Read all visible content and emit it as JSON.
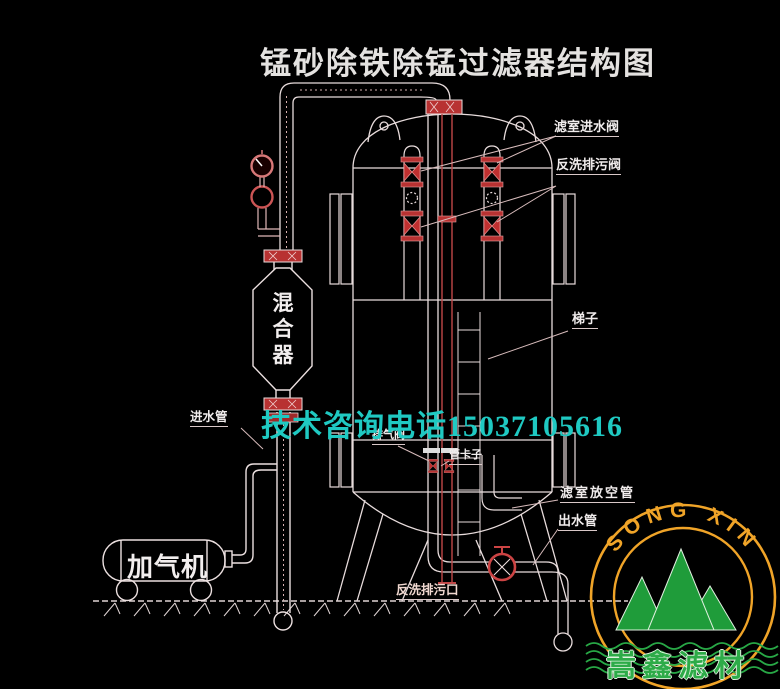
{
  "title": "锰砂除铁除锰过滤器结构图",
  "contact": {
    "phone_note": "技术咨询电话15037105616"
  },
  "labels": {
    "filter_inlet_valve": "滤室进水阀",
    "backwash_drain_valve": "反洗排污阀",
    "ladder": "梯子",
    "exhaust_valve": "排气阀",
    "pipe_clamp": "管卡子",
    "inlet_pipe": "进水管",
    "filter_vent_pipe": "滤室放空管",
    "outlet_pipe": "出水管",
    "backwash_drain_outlet": "反洗排污口"
  },
  "equipment": {
    "mixer": "混合器",
    "aerator": "加气机"
  },
  "logo": {
    "arc_text": "SONG XIN",
    "company_name": "嵩鑫滤材"
  },
  "colors": {
    "background": "#000000",
    "line": "#e8dcdc",
    "accent_red": "#b83232",
    "phone_text": "#1fc9c2",
    "logo_ring": "#f0a428",
    "logo_green": "#1f9c3a"
  }
}
